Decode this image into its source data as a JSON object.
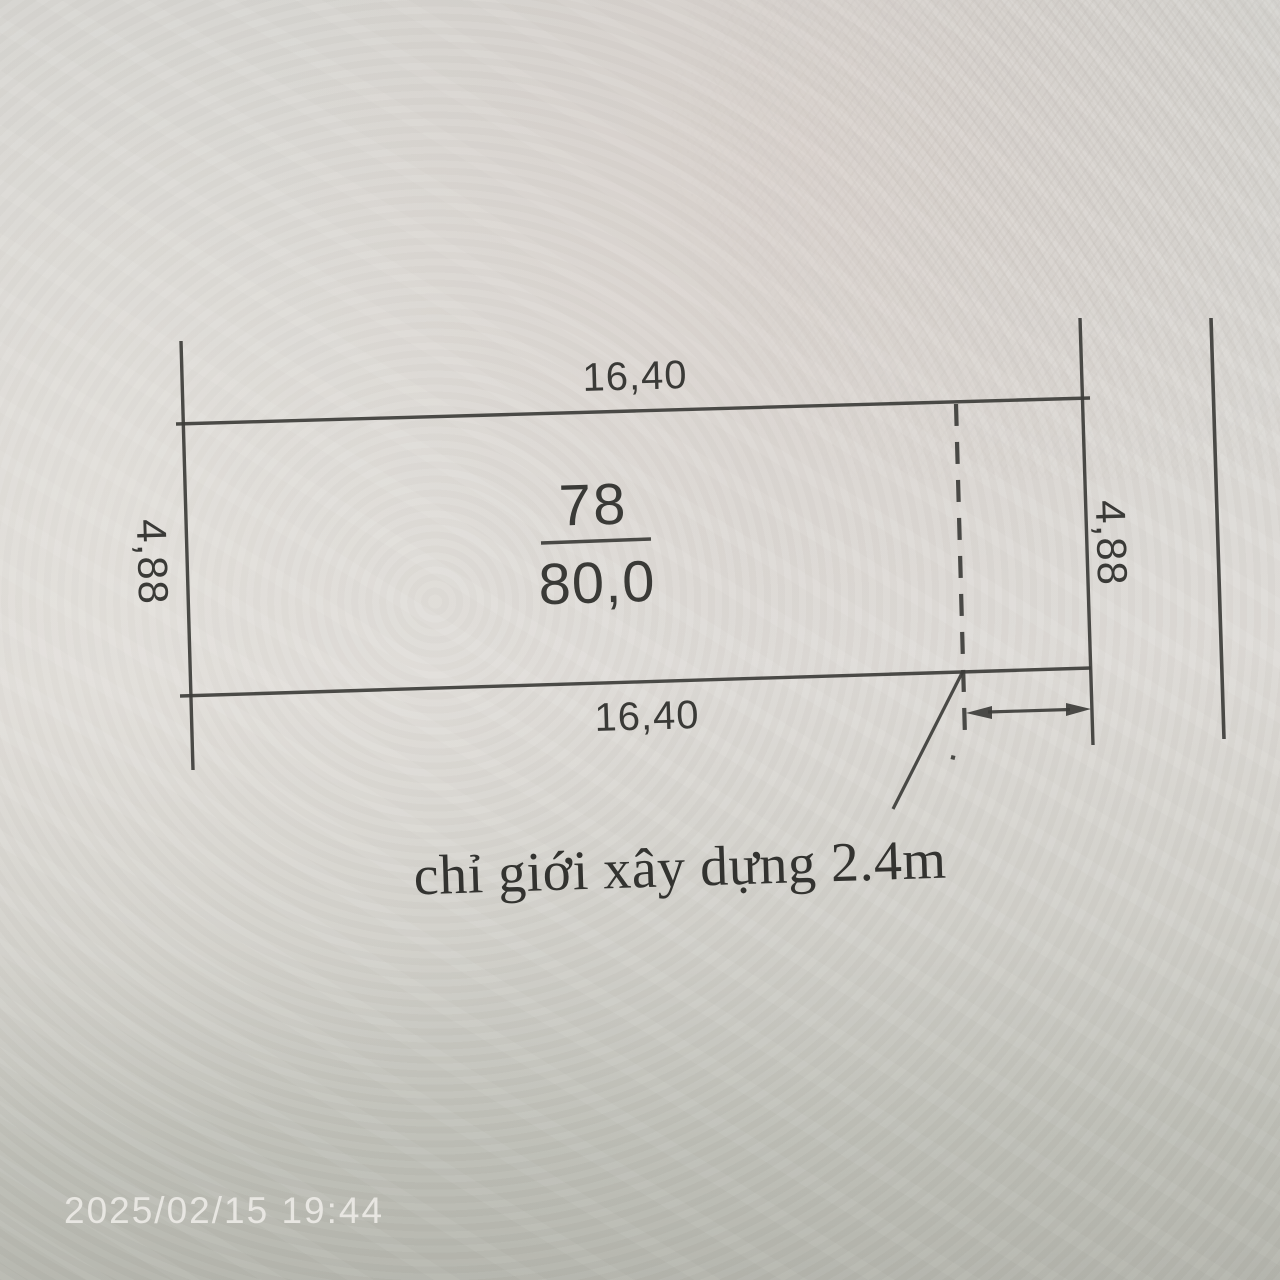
{
  "parcel": {
    "number": "78",
    "area": "80,0"
  },
  "dimensions": {
    "top": "16,40",
    "bottom": "16,40",
    "left": "4,88",
    "right": "4,88"
  },
  "annotation": {
    "setback": "chỉ giới xây dựng 2.4m"
  },
  "photo": {
    "timestamp": "2025/02/15 19:44"
  },
  "colors": {
    "ink": "#3d3d3a",
    "timestamp_text": "#eceae6",
    "paper_top": "#d6d5d1",
    "paper_bottom": "#b1b2aa"
  }
}
